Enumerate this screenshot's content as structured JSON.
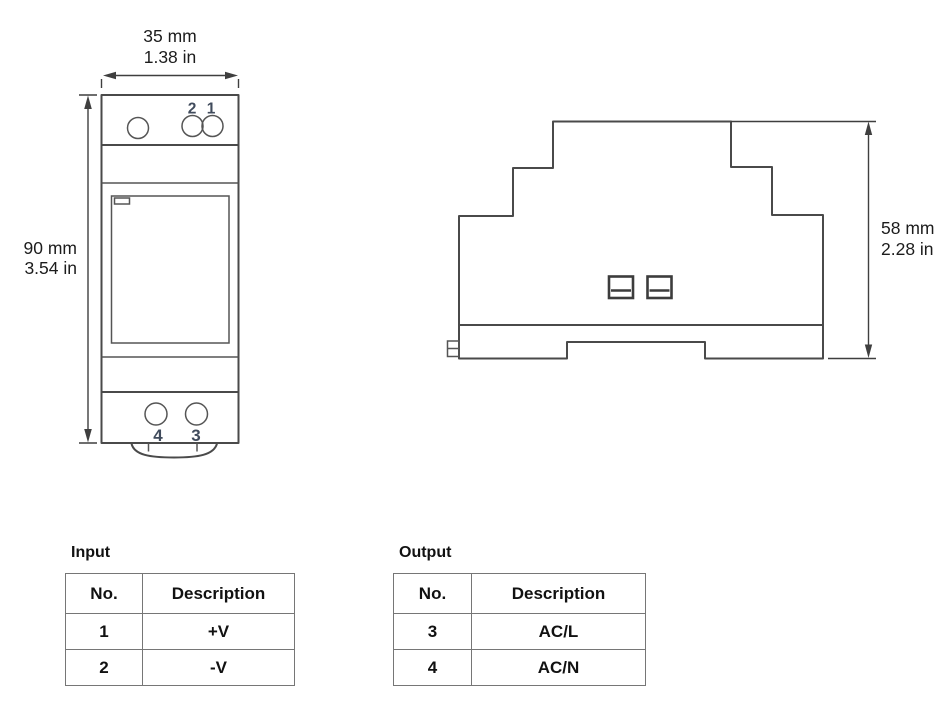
{
  "drawing": {
    "front_view": {
      "top_dim_mm": "35 mm",
      "top_dim_in": "1.38 in",
      "left_dim_mm": "90 mm",
      "left_dim_in": "3.54 in",
      "pin2_label": "2",
      "pin1_label": "1",
      "pin4_label": "4",
      "pin3_label": "3"
    },
    "side_view": {
      "right_dim_mm": "58 mm",
      "right_dim_in": "2.28 in"
    }
  },
  "tables": {
    "input": {
      "title": "Input",
      "headers": [
        "No.",
        "Description"
      ],
      "rows": [
        [
          "1",
          "+V"
        ],
        [
          "2",
          "-V"
        ]
      ]
    },
    "output": {
      "title": "Output",
      "headers": [
        "No.",
        "Description"
      ],
      "rows": [
        [
          "3",
          "AC/L"
        ],
        [
          "4",
          "AC/N"
        ]
      ]
    }
  },
  "colors": {
    "line": "#4a4a4a",
    "pin_number_text": "#404b5c",
    "dimension_text": "#1c1c1c",
    "table_border": "#767676",
    "table_text": "#111111",
    "background": "#ffffff"
  }
}
